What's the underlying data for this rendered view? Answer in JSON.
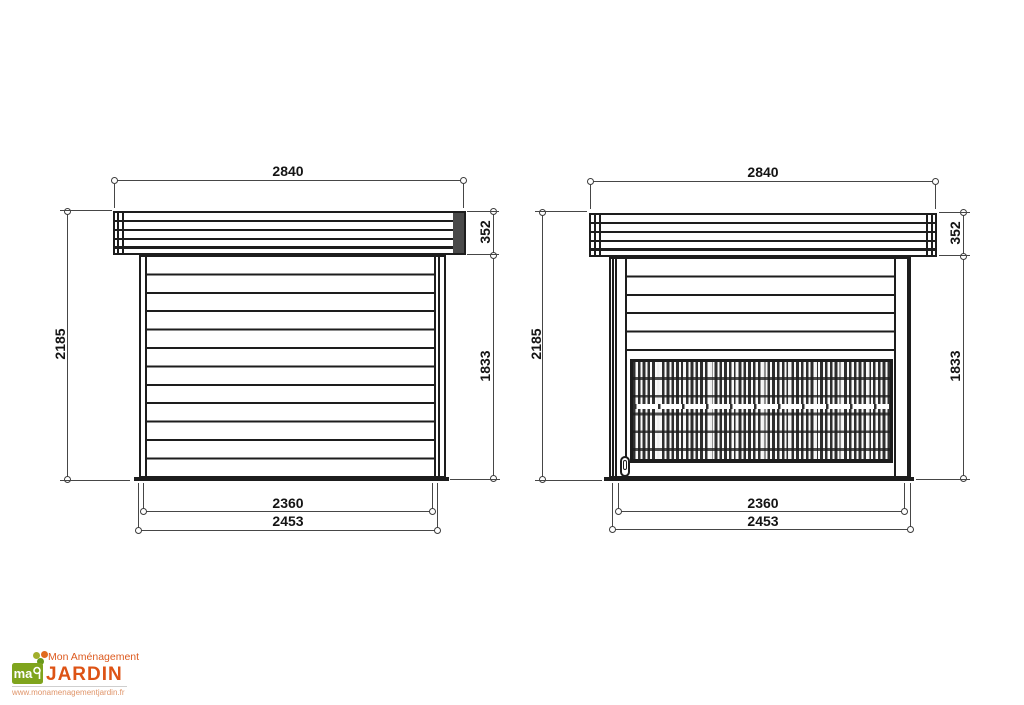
{
  "drawings": [
    {
      "id": "left-elevation",
      "dims": {
        "overall_width": "2840",
        "roof_thickness": "352",
        "overall_height": "2185",
        "wall_height": "1833",
        "inner_width": "2360",
        "outer_width": "2453"
      }
    },
    {
      "id": "right-elevation-lattice",
      "dims": {
        "overall_width": "2840",
        "roof_thickness": "352",
        "overall_height": "2185",
        "wall_height": "1833",
        "inner_width": "2360",
        "outer_width": "2453"
      }
    }
  ],
  "logo": {
    "tagline": "Mon Aménagement",
    "brand": "JARDIN",
    "monogram": "ma",
    "website": "www.monamenagementjardin.fr"
  },
  "colors": {
    "drawing_line": "#1d1d1d",
    "dimension_line": "#464646",
    "roof_cap_fill": "#4a4a4a",
    "logo_green": "#7fa41d",
    "logo_orange": "#dd5315",
    "logo_url_color": "#e0956a"
  }
}
